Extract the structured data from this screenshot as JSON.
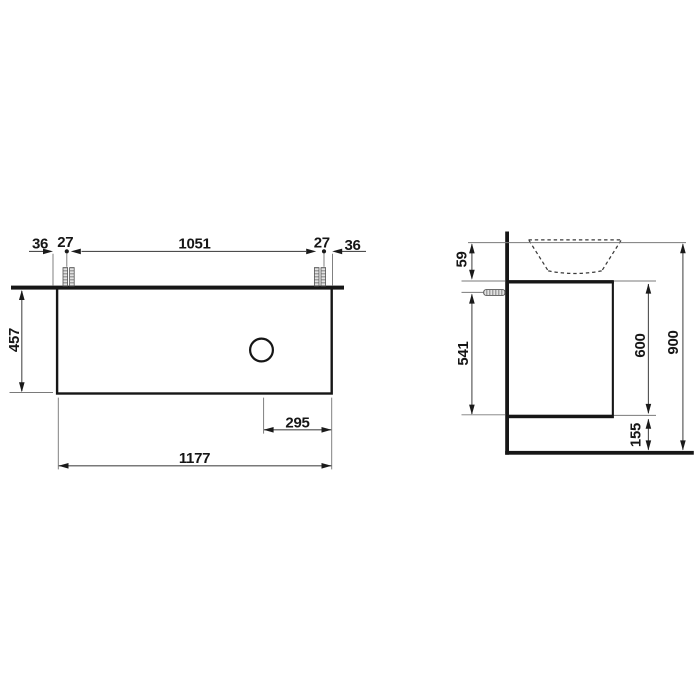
{
  "drawing": {
    "front_view": {
      "top_chain": [
        "36",
        "27",
        "1051",
        "27",
        "36"
      ],
      "height_label": "457",
      "drain_offset_label": "295",
      "total_width_label": "1177"
    },
    "side_view": {
      "basin_gap_label": "59",
      "anchor_to_bottom_label": "541",
      "body_height_label": "600",
      "total_height_label": "900",
      "floor_clearance_label": "155"
    },
    "colors": {
      "object_line": "#161616",
      "dimension_line": "#4d4d4d",
      "extension_line": "#7a7a7a",
      "background": "#ffffff"
    }
  }
}
